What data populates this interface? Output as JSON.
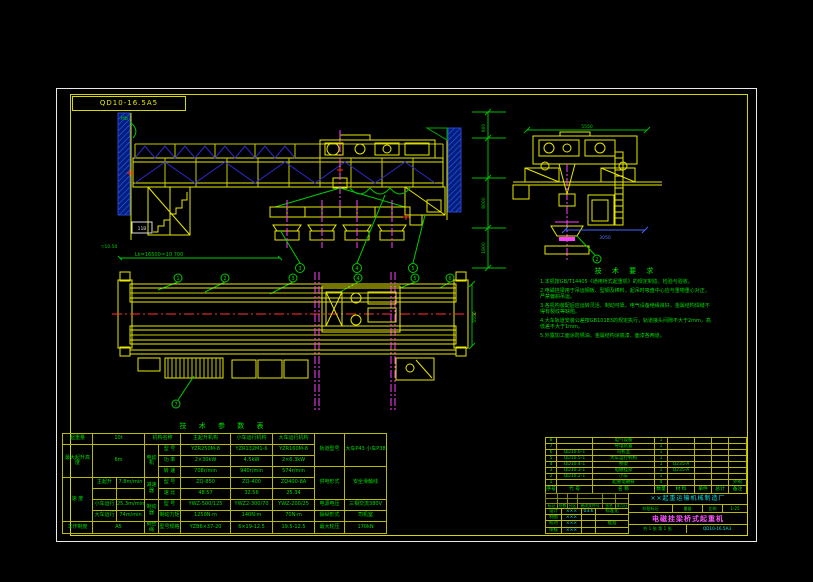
{
  "meta": {
    "corner_label": "QD10-16.5A5"
  },
  "notes": {
    "title": "技 术 要 求",
    "items": [
      "1.本机按GB/T14405《通用桥式起重机》的规定制造、检验与验收。",
      "2.电磁挂梁用于吊运钢板、型钢及棒料，起吊时吸盘中心应与重物重心对正，严禁偏斜吊运。",
      "3.各机构装配后应运转灵活、制动可靠，电气设备绝缘良好，金属结构焊缝不得有裂纹等缺陷。",
      "4.大车轨道安装公差按GB10183的规定执行，轨道接头间隙不大于2mm，高低差不大于1mm。",
      "5.外露加工面涂防锈油，金属结构涂底漆、面漆各两道。"
    ]
  },
  "dims": {
    "span": "Lk=16500＝10 700",
    "rail_level": "▽10.50",
    "hb": "Hb",
    "cab_box": "11B",
    "end_top": "5550",
    "end_bottom": "3050",
    "plan_right": "5550",
    "chain": [
      "900",
      "8000",
      "1800"
    ]
  },
  "balloons": {
    "plan": [
      "1",
      "2",
      "3",
      "4",
      "5",
      "6",
      "7"
    ],
    "elev": [
      "3",
      "4",
      "5"
    ],
    "end": "2"
  },
  "params": {
    "title": "技 术 参 数 表",
    "left": {
      "capacity_label": "起重量",
      "capacity_value": "10t",
      "height_label": "最大起升高度",
      "height_value": "6m",
      "speed_label": "速 度",
      "speed_rows": [
        {
          "label": "主起升",
          "value": "7.8m/min"
        },
        {
          "label": "",
          "value": ""
        },
        {
          "label": "小车运行",
          "value": "25.3m/min"
        },
        {
          "label": "大车运行",
          "value": "74m/min"
        }
      ],
      "duty_label": "工作制度",
      "duty_value": "A5"
    },
    "mech": {
      "name_header": "机构名称",
      "cols": [
        "主起升机构",
        "小车运行机构",
        "大车运行机构"
      ],
      "motor": "电动机",
      "reducer": "减速器",
      "brake": "制动器",
      "rope": "钢丝绳",
      "rows": [
        {
          "label": "型 号",
          "c1": "YZR250M-8",
          "c2": "YZR132M1-6",
          "c3": "YZR160M-8"
        },
        {
          "label": "功 率",
          "c1": "2×30kW",
          "c2": "4.5kW",
          "c3": "2×6.3kW"
        },
        {
          "label": "转 速",
          "c1": "708r/min",
          "c2": "940r/min",
          "c3": "574r/min"
        },
        {
          "label": "型 号",
          "c1": "ZQ-850",
          "c2": "ZQ-400",
          "c3": "ZQ400-8A"
        },
        {
          "label": "速 比",
          "c1": "48.57",
          "c2": "32.56",
          "c3": "25.34"
        },
        {
          "label": "型 号",
          "c1": "YWZ-500/125",
          "c2": "YWZ2-300/70",
          "c3": "YWZ-200/25"
        },
        {
          "label": "制动力矩",
          "c1": "1250N·m",
          "c2": "140N·m",
          "c3": "70N·m"
        },
        {
          "label": "型号规格",
          "c1": "YZB6×37-20",
          "c2": "6×19-12.5",
          "c3": "19.5-12.5"
        }
      ]
    },
    "right": {
      "rows": [
        {
          "label": "轨道型号",
          "value": "大车P43 小车P38"
        },
        {
          "label": "供电形式",
          "value": "安全滑触线"
        },
        {
          "label": "电源电压",
          "value": "三相交流380V"
        },
        {
          "label": "操纵形式",
          "value": "司机室"
        },
        {
          "label": "最大轮压",
          "value": "170kN"
        }
      ]
    }
  },
  "bom": {
    "headers": [
      "序号",
      "代 号",
      "名 称",
      "数量",
      "材 料",
      "单件",
      "总计",
      "备注"
    ],
    "rows": [
      {
        "no": "8",
        "code": "",
        "name": "电气设备",
        "qty": "1",
        "mat": "",
        "w1": "",
        "w2": "",
        "rem": ""
      },
      {
        "no": "7",
        "code": "",
        "name": "导电装置",
        "qty": "1",
        "mat": "",
        "w1": "",
        "w2": "",
        "rem": ""
      },
      {
        "no": "6",
        "code": "QD10.6-1",
        "name": "司机室",
        "qty": "1",
        "mat": "",
        "w1": "",
        "w2": "",
        "rem": ""
      },
      {
        "no": "5",
        "code": "QD10.5-1",
        "name": "大车运行机构",
        "qty": "1",
        "mat": "",
        "w1": "",
        "w2": "",
        "rem": ""
      },
      {
        "no": "4",
        "code": "QD10.4-1",
        "name": "桥架",
        "qty": "1",
        "mat": "Q235-A",
        "w1": "",
        "w2": "",
        "rem": ""
      },
      {
        "no": "3",
        "code": "QD10.3-1",
        "name": "电磁挂梁",
        "qty": "1",
        "mat": "Q235-A",
        "w1": "",
        "w2": "",
        "rem": ""
      },
      {
        "no": "2",
        "code": "QD10.2-1",
        "name": "小车",
        "qty": "1",
        "mat": "",
        "w1": "",
        "w2": "",
        "rem": ""
      },
      {
        "no": "1",
        "code": "",
        "name": "起重电磁铁",
        "qty": "4",
        "mat": "",
        "w1": "",
        "w2": "",
        "rem": "外购"
      }
    ]
  },
  "titleblock": {
    "company": "××起重运输机械制造厂",
    "drawing_title": "电磁挂梁桥式起重机",
    "drawing_no": "QD10-16.5A3",
    "stage": [
      "阶段标记",
      "重量",
      "比例"
    ],
    "stage_vals": [
      "",
      "",
      "1:25"
    ],
    "sheet": "共 1 张  第 1 张",
    "rev_labels": [
      "标记",
      "处数",
      "分区",
      "更改文件号",
      "签名",
      "年月日"
    ],
    "sig": [
      {
        "l": "设计",
        "v": "×××",
        "d": "03.6",
        "r": "标准化"
      },
      {
        "l": "制图",
        "v": "×××",
        "d": "",
        "r": ""
      },
      {
        "l": "校对",
        "v": "×××",
        "d": "",
        "r": "批准"
      },
      {
        "l": "审核",
        "v": "×××",
        "d": "",
        "r": ""
      }
    ]
  }
}
